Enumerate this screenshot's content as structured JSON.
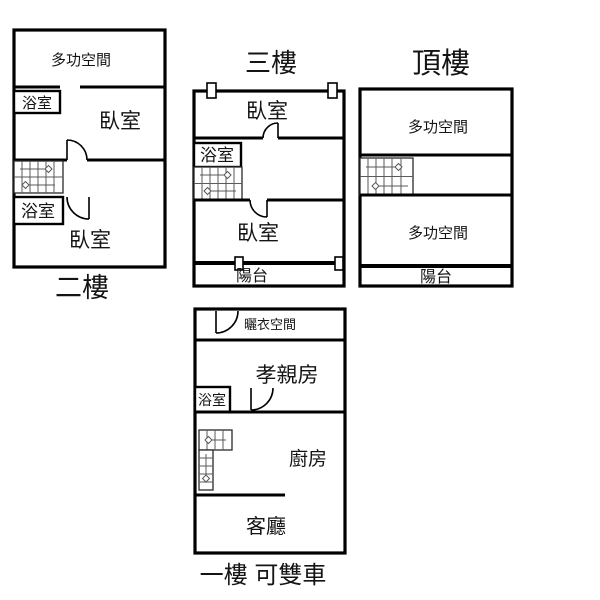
{
  "colors": {
    "background": "#ffffff",
    "wall": "#000000",
    "stair_lines": "#5a5a5a",
    "text": "#141414"
  },
  "floors": {
    "floor2": {
      "name": "二樓",
      "rooms": {
        "multi": "多功空間",
        "bath1": "浴室",
        "bed1": "臥室",
        "bath2": "浴室",
        "bed2": "臥室"
      }
    },
    "floor3": {
      "name": "三樓",
      "rooms": {
        "bed1": "臥室",
        "bath": "浴室",
        "bed2": "臥室",
        "balcony": "陽台"
      }
    },
    "floorTop": {
      "name": "頂樓",
      "rooms": {
        "multi1": "多功空間",
        "multi2": "多功空間",
        "balcony": "陽台"
      }
    },
    "floor1": {
      "name": "一樓 可雙車",
      "rooms": {
        "laundry": "曬衣空間",
        "parents": "孝親房",
        "bath": "浴室",
        "kitchen": "廚房",
        "living": "客廳"
      }
    }
  }
}
